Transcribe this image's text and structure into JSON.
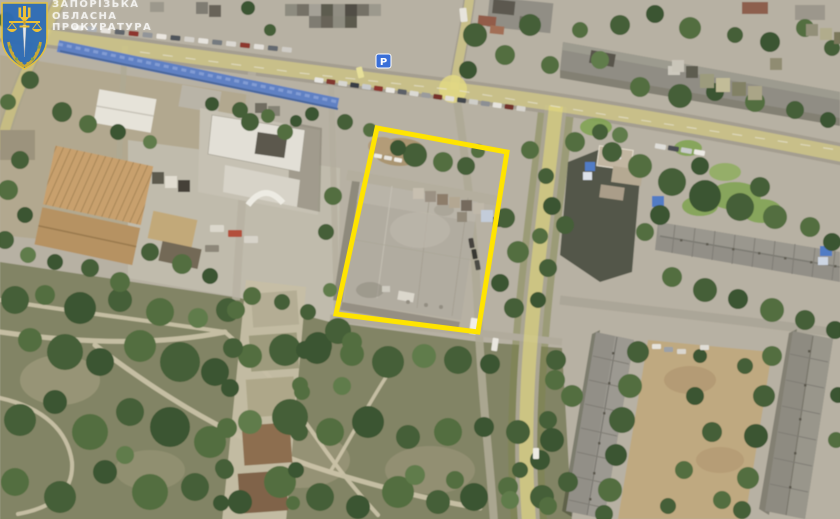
{
  "image": {
    "type": "satellite-photo-with-annotation",
    "description": "Aerial satellite view of a city block; a large flat-roofed building is outlined in yellow; watermark of the Zaporizhzhia Oblast Prosecutor's Office in the top-left corner"
  },
  "watermark": {
    "org_lines": [
      "ЗАПОРІЗЬКА",
      "ОБЛАСНА",
      "ПРОКУРАТУРА"
    ],
    "text_color": "rgba(255,255,255,0.75)",
    "logo_colors": {
      "shield": "#2D6CB5",
      "trident": "#F2C230",
      "sword": "#E8ECF2",
      "wreath": "#C9A832"
    }
  },
  "annotation": {
    "shape": "quadrilateral-outline",
    "points_str": "377,128 507,152 478,332 336,314",
    "color": "#FFE400",
    "stroke_width": "5"
  },
  "poi": {
    "parking_sign_label": "P",
    "sign_color": "#3A6FD8"
  },
  "palette": {
    "road_overlay": "#E8DC82",
    "market_roofs": "#5B7EC6",
    "pavement": "#B6B1A4",
    "park": "#7E8162",
    "tree_dark": "#3D5931",
    "building_roof": "#B0ACA1"
  }
}
